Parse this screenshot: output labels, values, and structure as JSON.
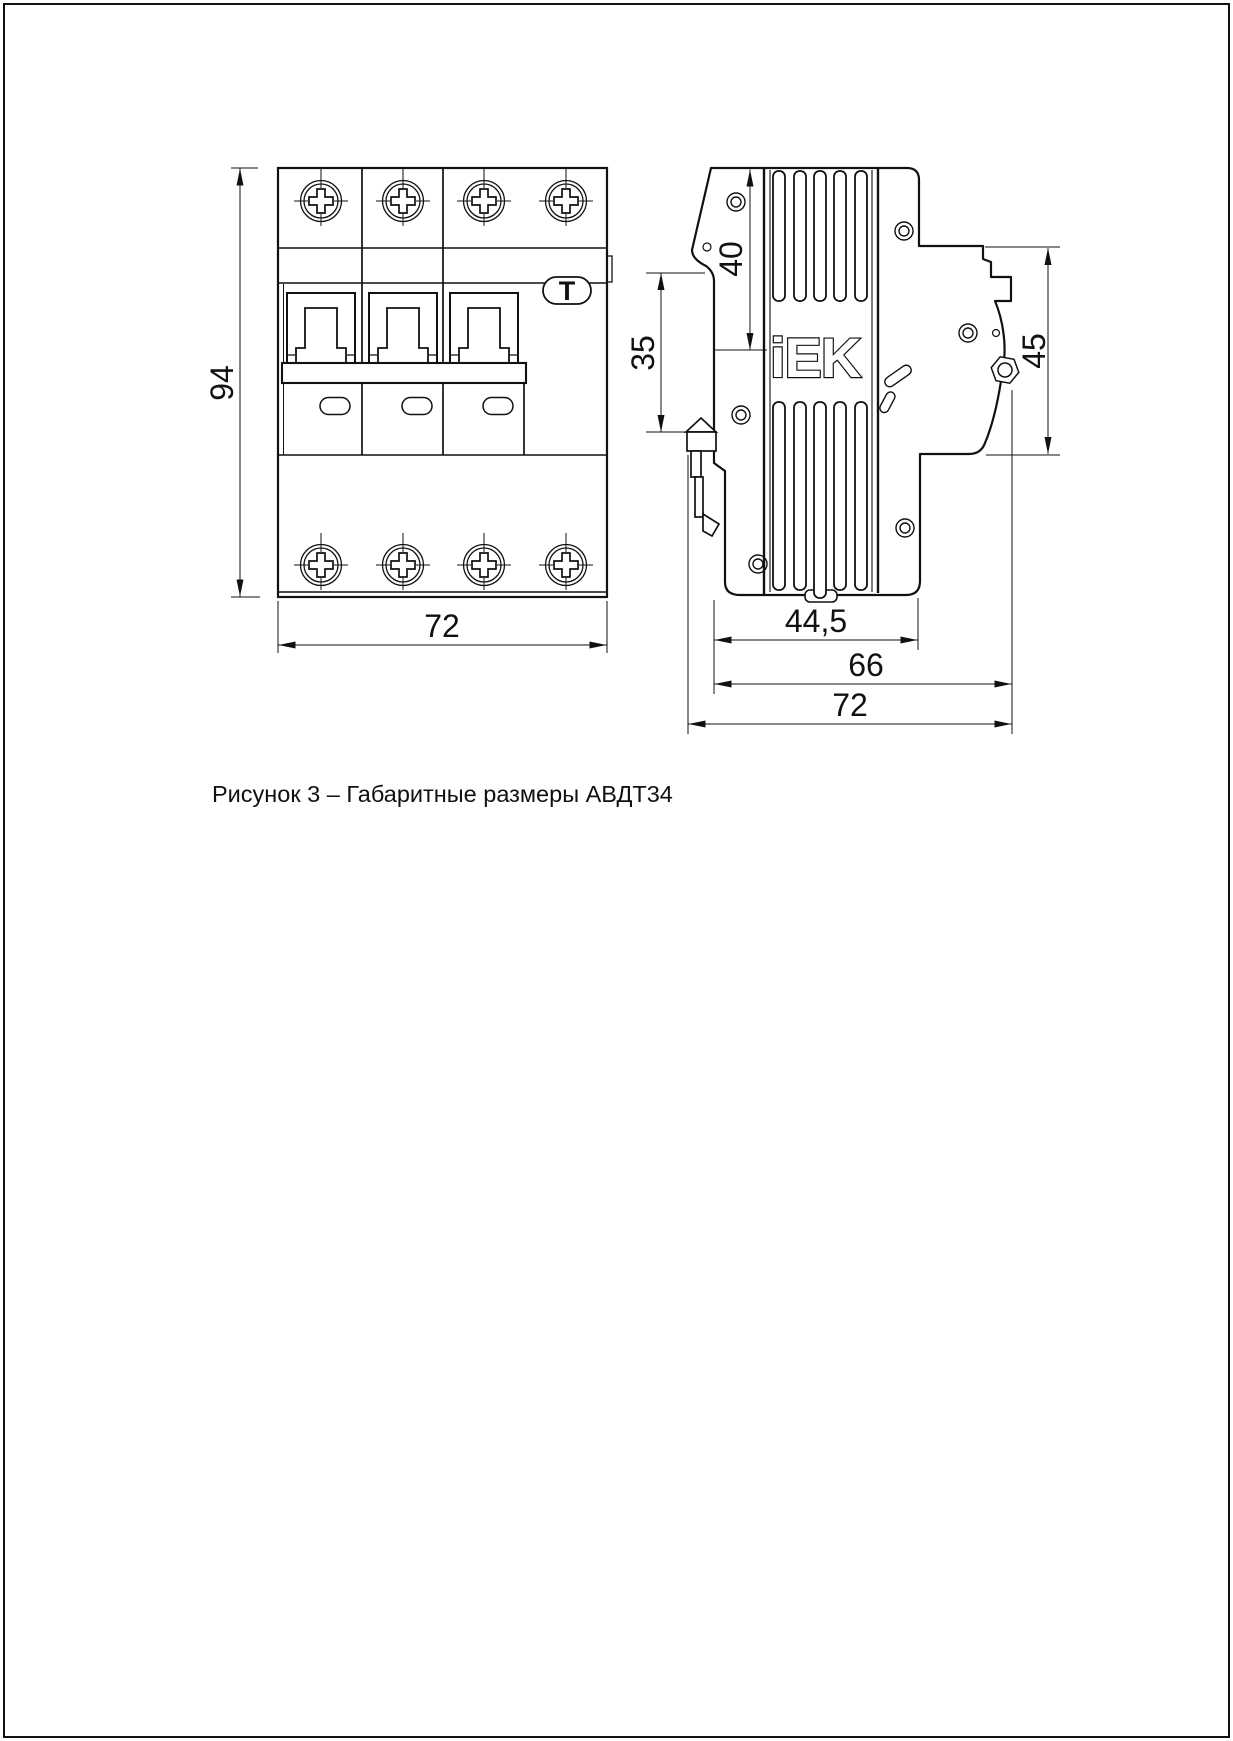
{
  "page": {
    "caption": "Рисунок 3 – Габаритные размеры АВДТ34"
  },
  "figure": {
    "brand_logo": "iEK",
    "test_button_label": "T",
    "dimensions": {
      "front_height": "94",
      "front_width": "72",
      "top_to_rail_seat": "40",
      "rail_seat_width": "35",
      "panel_height": "45",
      "body_depth": "44,5",
      "depth_with_terminals": "66",
      "overall_depth": "72"
    }
  }
}
